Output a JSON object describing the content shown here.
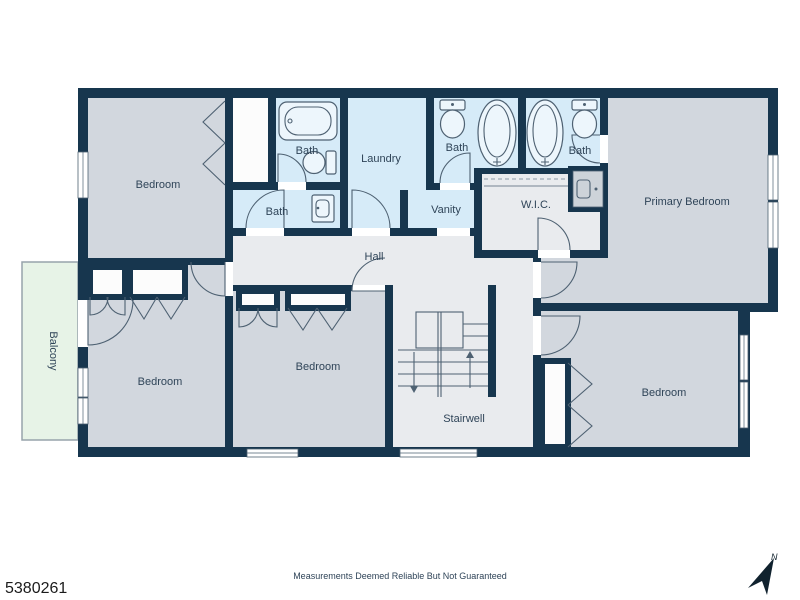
{
  "plan": {
    "rooms": {
      "bedroom_top_left": {
        "label": "Bedroom"
      },
      "bath_top": {
        "label": "Bath"
      },
      "bath_second": {
        "label": "Bath"
      },
      "laundry": {
        "label": "Laundry"
      },
      "bath_center": {
        "label": "Bath"
      },
      "bath_east": {
        "label": "Bath"
      },
      "vanity": {
        "label": "Vanity"
      },
      "wic": {
        "label": "W.I.C."
      },
      "hall": {
        "label": "Hall"
      },
      "primary_bedroom": {
        "label": "Primary Bedroom"
      },
      "bedroom_left": {
        "label": "Bedroom"
      },
      "bedroom_center": {
        "label": "Bedroom"
      },
      "bedroom_right": {
        "label": "Bedroom"
      },
      "stairwell": {
        "label": "Stairwell"
      },
      "balcony": {
        "label": "Balcony"
      }
    },
    "colors": {
      "wall": "#17364E",
      "bedroom_fill": "#D2D7DE",
      "bath_fill": "#D6EBF8",
      "circulation_fill": "#E9EBEE",
      "closet_fill": "#FCFCFC",
      "balcony_fill": "#E7F3E7",
      "line": "#4E6172",
      "label_text": "#2F4458"
    }
  },
  "footer": {
    "listing_id": "5380261",
    "disclaimer": "Measurements Deemed Reliable But Not Guaranteed",
    "compass_label": "N"
  }
}
